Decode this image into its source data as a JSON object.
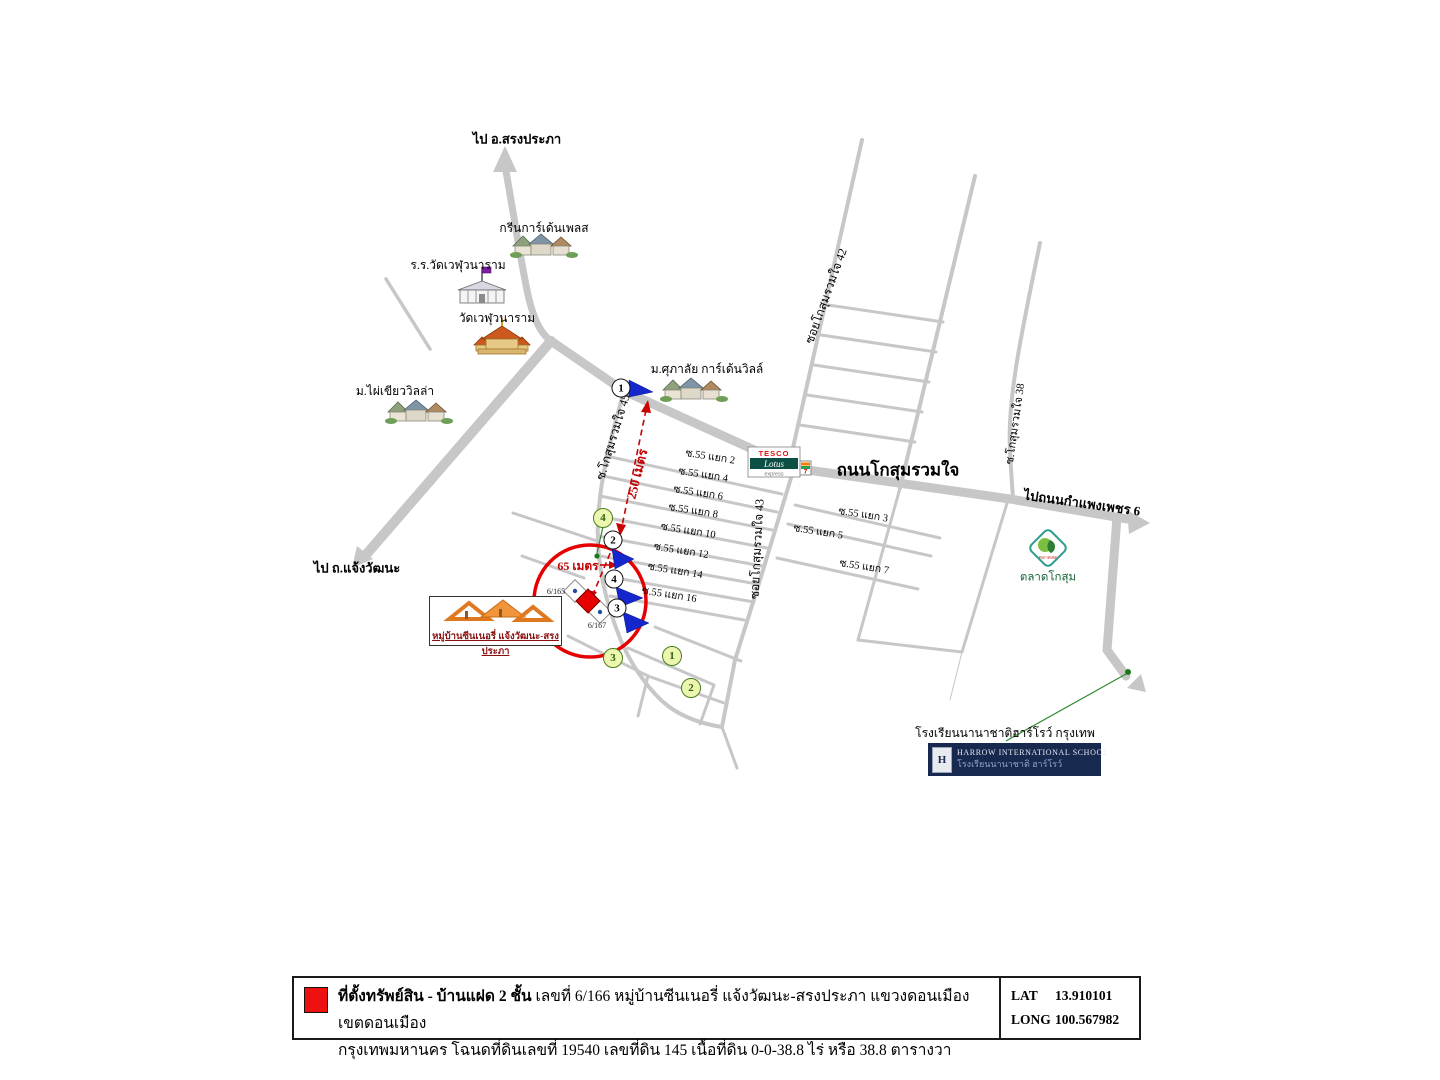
{
  "destinations": {
    "north": "ไป อ.สรงประภา",
    "southwest": "ไป ถ.แจ้งวัฒนะ",
    "east": "ไปถนนกำแพงเพชร 6"
  },
  "roads": {
    "main": "ถนนโกสุมรวมใจ",
    "soi45": "ซ.โกสุมรวมใจ 45",
    "soi42": "ซอยโกสุมรวมใจ 42",
    "soi43": "ซอยโกสุมรวมใจ 43",
    "soi38": "ซ.โกสุมรวมใจ 38",
    "branches_left": [
      "ซ.55 แยก 2",
      "ซ.55 แยก 4",
      "ซ.55 แยก 6",
      "ซ.55 แยก 8",
      "ซ.55 แยก 10",
      "ซ.55 แยก 12",
      "ซ.55 แยก 14",
      "ซ.55 แยก 16"
    ],
    "branches_right": [
      "ซ.55 แยก 3",
      "ซ.55 แยก 5",
      "ซ.55 แยก 7"
    ]
  },
  "places": {
    "green_garden": "กรีนการ์เด้นเพลส",
    "school_wat": "ร.ร.วัดเวฬุวนาราม",
    "wat": "วัดเวฬุวนาราม",
    "phai_khiao": "ม.ไผ่เขียววิลล่า",
    "supalai": "ม.ศุภาลัย การ์เด้นวิลล์",
    "market": "ตลาดโกสุม",
    "market_small": "ตลาดสด",
    "village_box": "หมู่บ้านซีนเนอรี่ แจ้งวัฒนะ-สรงประภา",
    "harrow_text": "โรงเรียนนานาชาติฮาร์โรว์ กรุงเทพ",
    "harrow_banner_en": "HARROW INTERNATIONAL SCHOOL",
    "harrow_banner_th": "โรงเรียนนานาชาติ ฮาร์โรว์",
    "harrow_crest_letter": "H",
    "tesco_top": "TESCO",
    "tesco_mid": "Lotus",
    "tesco_bottom": "express",
    "seven_eleven": "7"
  },
  "measurements": {
    "d250": "250 เมตร",
    "d65": "65 เมตร"
  },
  "house_numbers": {
    "left": "6/165",
    "bottom": "6/167"
  },
  "route_markers": [
    "1",
    "2",
    "3",
    "4"
  ],
  "photo_markers": [
    "1",
    "2",
    "3",
    "4"
  ],
  "legend": {
    "line1_lead": "ที่ตั้งทรัพย์สิน - บ้านแฝด 2 ชั้น",
    "line1_rest": " เลขที่ 6/166 หมู่บ้านซีนเนอรี่ แจ้งวัฒนะ-สรงประภา แขวงดอนเมือง เขตดอนเมือง",
    "line2": "กรุงเทพมหานคร โฉนดที่ดินเลขที่ 19540 เลขที่ดิน 145 เนื้อที่ดิน 0-0-38.8 ไร่ หรือ 38.8 ตารางวา",
    "lat_label": "LAT",
    "lat_value": "13.910101",
    "long_label": "LONG",
    "long_value": "100.567982"
  },
  "colors": {
    "road": "#c7c7c7",
    "highlight_red": "#e60000",
    "measure_red": "#cc0000",
    "marker_green_fill": "#ecf6ae",
    "marker_green_stroke": "#4a7d1e",
    "harrow_navy": "#17294f"
  }
}
